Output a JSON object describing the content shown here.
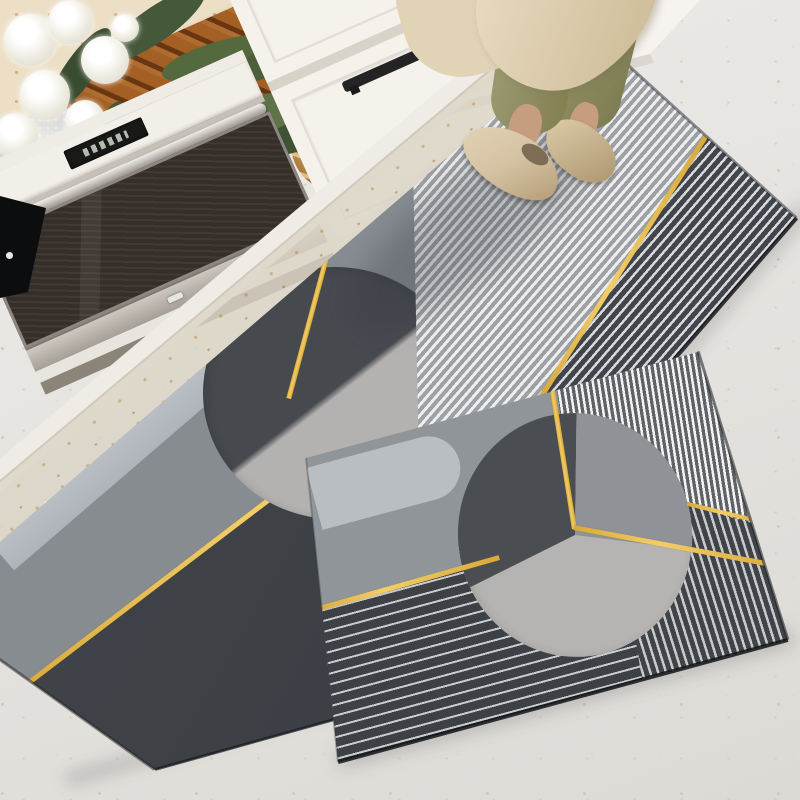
{
  "scene": {
    "type": "product-lifestyle-photo",
    "setting": "kitchen floor corner viewed from above at an angle",
    "subject": "two-piece geometric anti-slip kitchen mat set"
  },
  "objects": {
    "floor": {
      "label": "light speckled terrazzo floor"
    },
    "counter": {
      "label": "beige terrazzo countertop"
    },
    "cooktop": {
      "label": "black glass cooktop corner"
    },
    "bread_board": {
      "label": "wooden slatted bread board"
    },
    "bread": {
      "label": "two rustic bread loaves"
    },
    "plant": {
      "label": "white flowers with green leaves in glass vase"
    },
    "oven": {
      "label": "built-in oven with glass door and steel handle"
    },
    "drawers": {
      "label": "white cabinet drawers with black bar handles"
    },
    "tall_cabinet": {
      "label": "white tall cabinet"
    },
    "person": {
      "label": "person standing in olive trousers and beige flats"
    },
    "runner_rug": {
      "label": "long runner mat with gray geometric pattern and gold lines"
    },
    "small_rug": {
      "label": "smaller mat with circle, stripe panels and gold lines"
    }
  },
  "rug_pattern": {
    "style": "mid-century geometric",
    "elements": [
      "split circle",
      "thin stripe panels",
      "gold accent lines",
      "charcoal blocks",
      "pale band with rounded end"
    ]
  },
  "colors": {
    "floor": "#e6e4e0",
    "counter": "#ecdfc6",
    "cabinet": "#f5f2ec",
    "gold": "#d8a93a",
    "gold2": "#f2cd68",
    "rugMed": "#878c91",
    "rugDark": "#3c4045",
    "rugLight": "#b4b2b0",
    "rugPale": "#bcc1c6",
    "circleDark": "#46494e",
    "wood": "#a35f24",
    "pants": "#8f8d63",
    "shoes": "#d5c2a3",
    "coat": "#e0d3b6",
    "skin": "#c79d80",
    "ovenGlass": "#362f29",
    "steel": "#b5b0a8"
  }
}
